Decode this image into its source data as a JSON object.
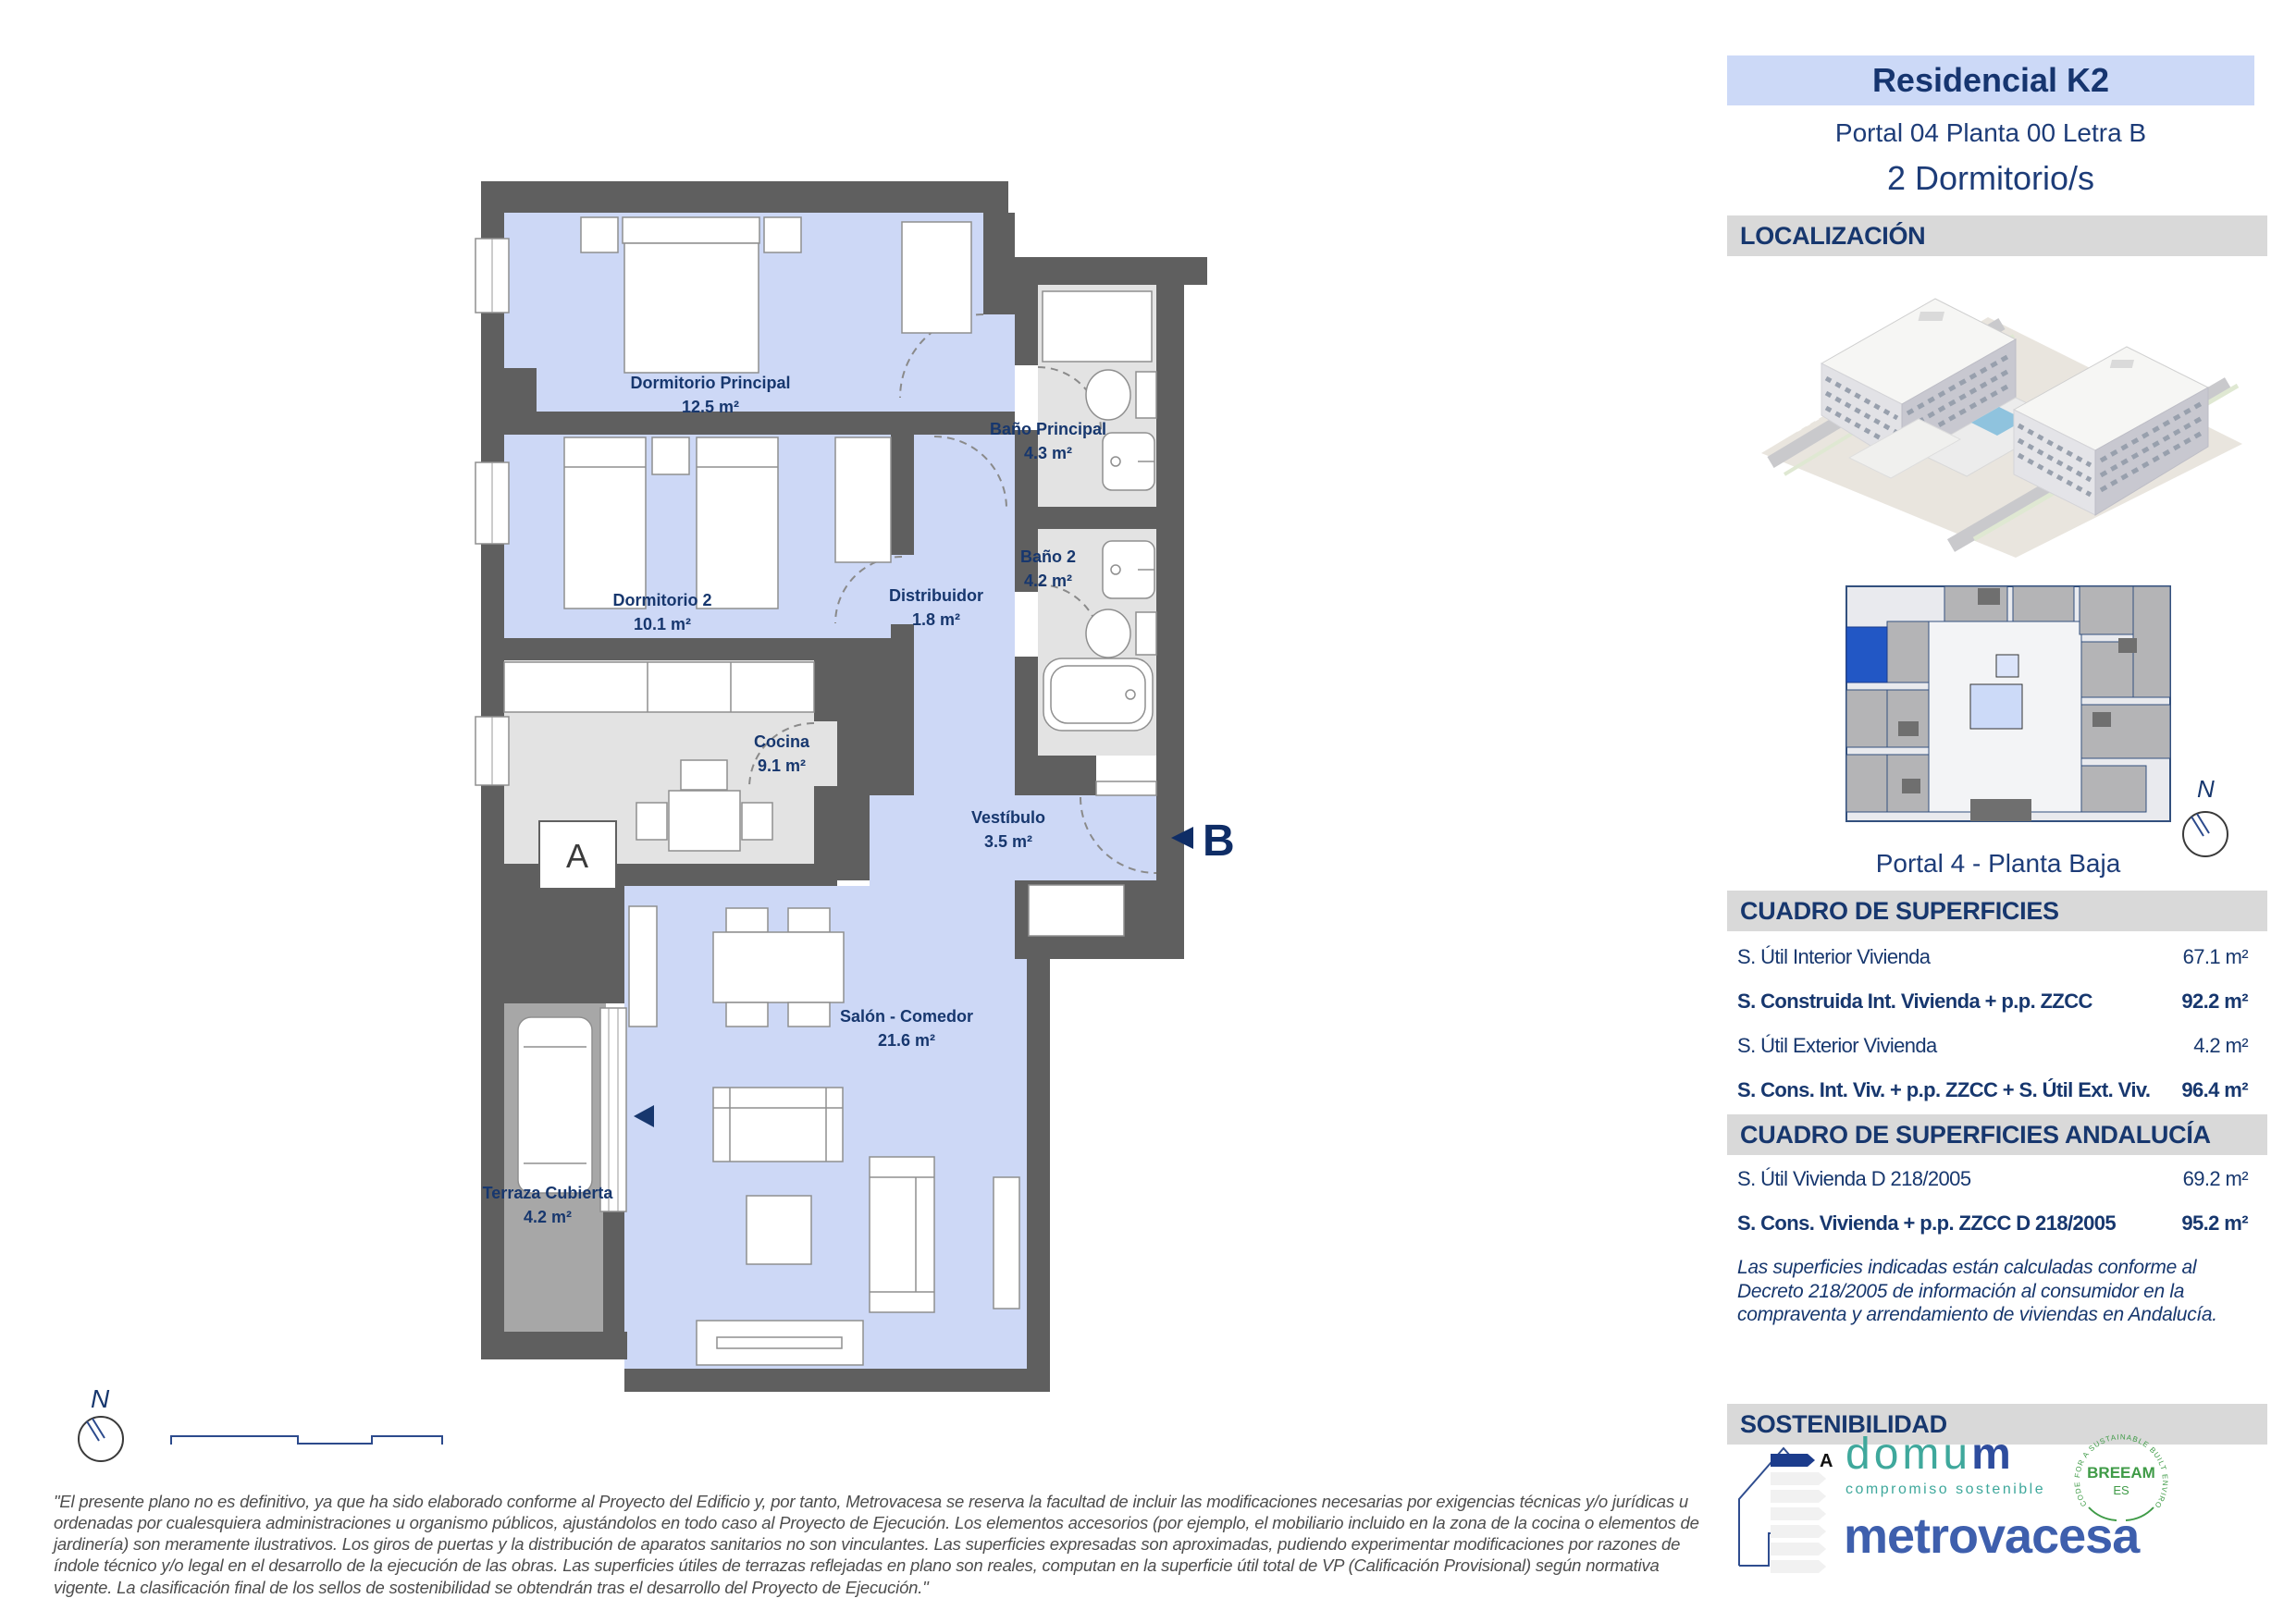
{
  "header": {
    "project": "Residencial K2",
    "unit": "Portal 04 Planta 00 Letra B",
    "bedrooms": "2 Dormitorio/s"
  },
  "localizacion": {
    "title": "LOCALIZACIÓN",
    "keyplan_caption": "Portal 4 - Planta Baja",
    "compass_label": "N"
  },
  "superficies": {
    "title": "CUADRO DE SUPERFICIES",
    "rows": [
      {
        "label": "S. Útil Interior Vivienda",
        "value": "67.1 m²",
        "bold": false
      },
      {
        "label": "S. Construida Int. Vivienda + p.p. ZZCC",
        "value": "92.2 m²",
        "bold": true
      },
      {
        "label": "S. Útil Exterior Vivienda",
        "value": "4.2 m²",
        "bold": false
      },
      {
        "label": "S. Cons. Int. Viv. + p.p. ZZCC + S. Útil Ext. Viv.",
        "value": "96.4 m²",
        "bold": true
      }
    ]
  },
  "andalucia": {
    "title": "CUADRO DE SUPERFICIES ANDALUCÍA",
    "rows": [
      {
        "label": "S. Útil Vivienda D 218/2005",
        "value": "69.2 m²",
        "bold": false
      },
      {
        "label": "S. Cons. Vivienda + p.p. ZZCC D 218/2005",
        "value": "95.2 m²",
        "bold": true
      }
    ],
    "note": "Las superficies indicadas están calculadas conforme al Decreto 218/2005 de información al consumidor en la compraventa y arrendamiento de viviendas en Andalucía."
  },
  "sostenibilidad": {
    "title": "SOSTENIBILIDAD",
    "energy_rating": "A",
    "domum_word_left": "domu",
    "domum_word_right": "m",
    "domum_tagline": "compromiso sostenible",
    "breeam_name": "BREEAM",
    "breeam_sub": "ES",
    "breeam_ring": "CODE FOR A SUSTAINABLE BUILT ENVIRONMENT",
    "brand": "metrovacesa"
  },
  "plan": {
    "compass_label": "N",
    "marker_a": "A",
    "marker_b": "B",
    "rooms": [
      {
        "name": "Dormitorio Principal",
        "area": "12.5 m²"
      },
      {
        "name": "Dormitorio 2",
        "area": "10.1 m²"
      },
      {
        "name": "Baño Principal",
        "area": "4.3 m²"
      },
      {
        "name": "Baño 2",
        "area": "4.2 m²"
      },
      {
        "name": "Distribuidor",
        "area": "1.8 m²"
      },
      {
        "name": "Cocina",
        "area": "9.1 m²"
      },
      {
        "name": "Vestíbulo",
        "area": "3.5 m²"
      },
      {
        "name": "Salón - Comedor",
        "area": "21.6 m²"
      },
      {
        "name": "Terraza Cubierta",
        "area": "4.2 m²"
      }
    ]
  },
  "disclaimer": {
    "text": "\"El presente plano no es definitivo, ya que ha sido elaborado conforme al Proyecto del Edificio y, por tanto, Metrovacesa se reserva la facultad de incluir las modificaciones necesarias por exigencias técnicas y/o jurídicas u ordenadas por cualesquiera administraciones u organismo públicos, ajustándolos en todo caso al Proyecto de Ejecución. Los elementos accesorios (por ejemplo, el mobiliario incluido en la zona de la cocina o elementos de jardinería) son meramente ilustrativos. Los giros de puertas y la distribución de aparatos sanitarios no son vinculantes. Las superficies expresadas son aproximadas, pudiendo experimentar modificaciones por razones de índole técnico y/o legal en el desarrollo de la ejecución de las obras. Las superficies útiles de terrazas reflejadas en plano son reales, computan en la superficie útil total de VP (Calificación Provisional) según normativa vigente. La clasificación final de los sellos de sostenibilidad se obtendrán tras el desarrollo del Proyecto de Ejecución.\""
  }
}
